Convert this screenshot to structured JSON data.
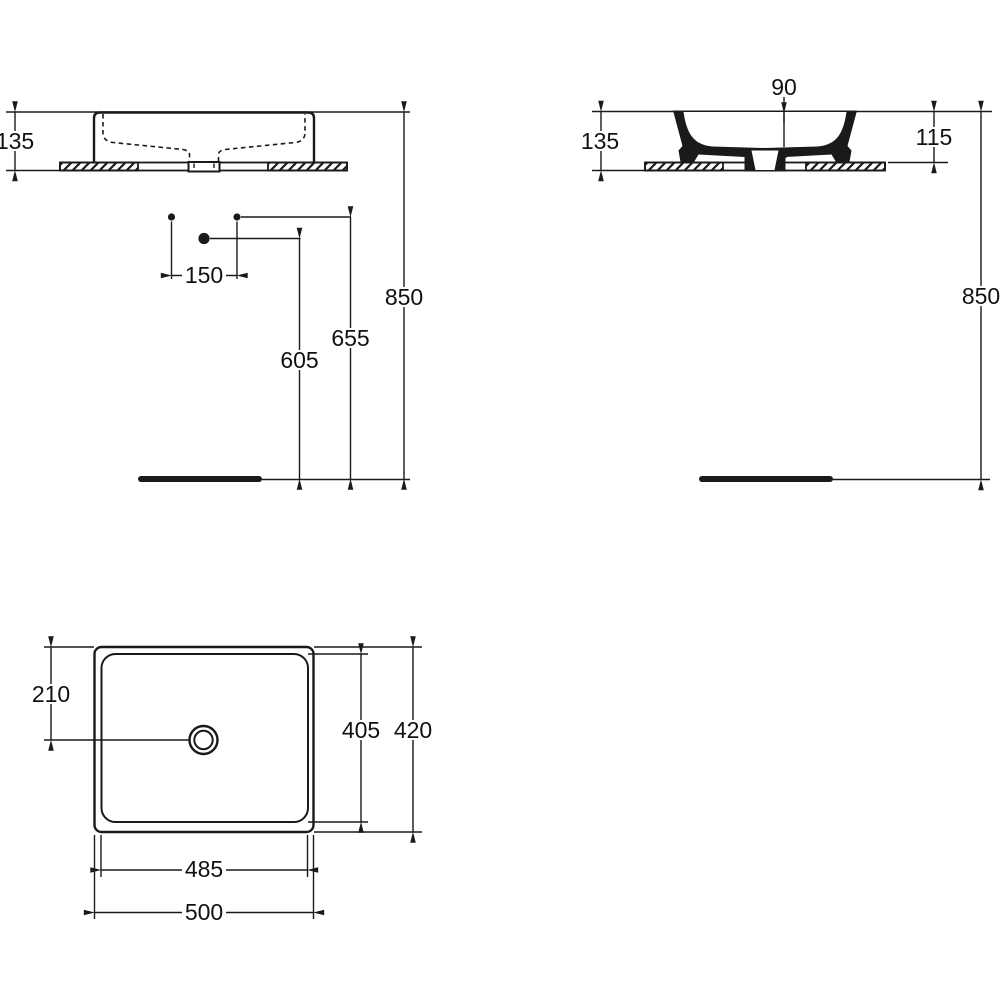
{
  "document": {
    "type": "technical dimension drawing",
    "subject": "countertop washbasin, three orthographic views"
  },
  "colors": {
    "ink": "#1a1a1a",
    "paper": "#ffffff"
  },
  "views": {
    "front": {
      "dim_height": "135",
      "dim_tap_spacing": "150",
      "dim_drain_height": "605",
      "dim_supply_height": "655",
      "dim_rim_height": "850"
    },
    "side": {
      "dim_bowl_depth": "90",
      "dim_height": "135",
      "dim_body_height": "115",
      "dim_rim_height": "850"
    },
    "plan": {
      "dim_drain_offset": "210",
      "dim_inner_depth": "405",
      "dim_outer_depth": "420",
      "dim_inner_width": "485",
      "dim_outer_width": "500"
    }
  }
}
